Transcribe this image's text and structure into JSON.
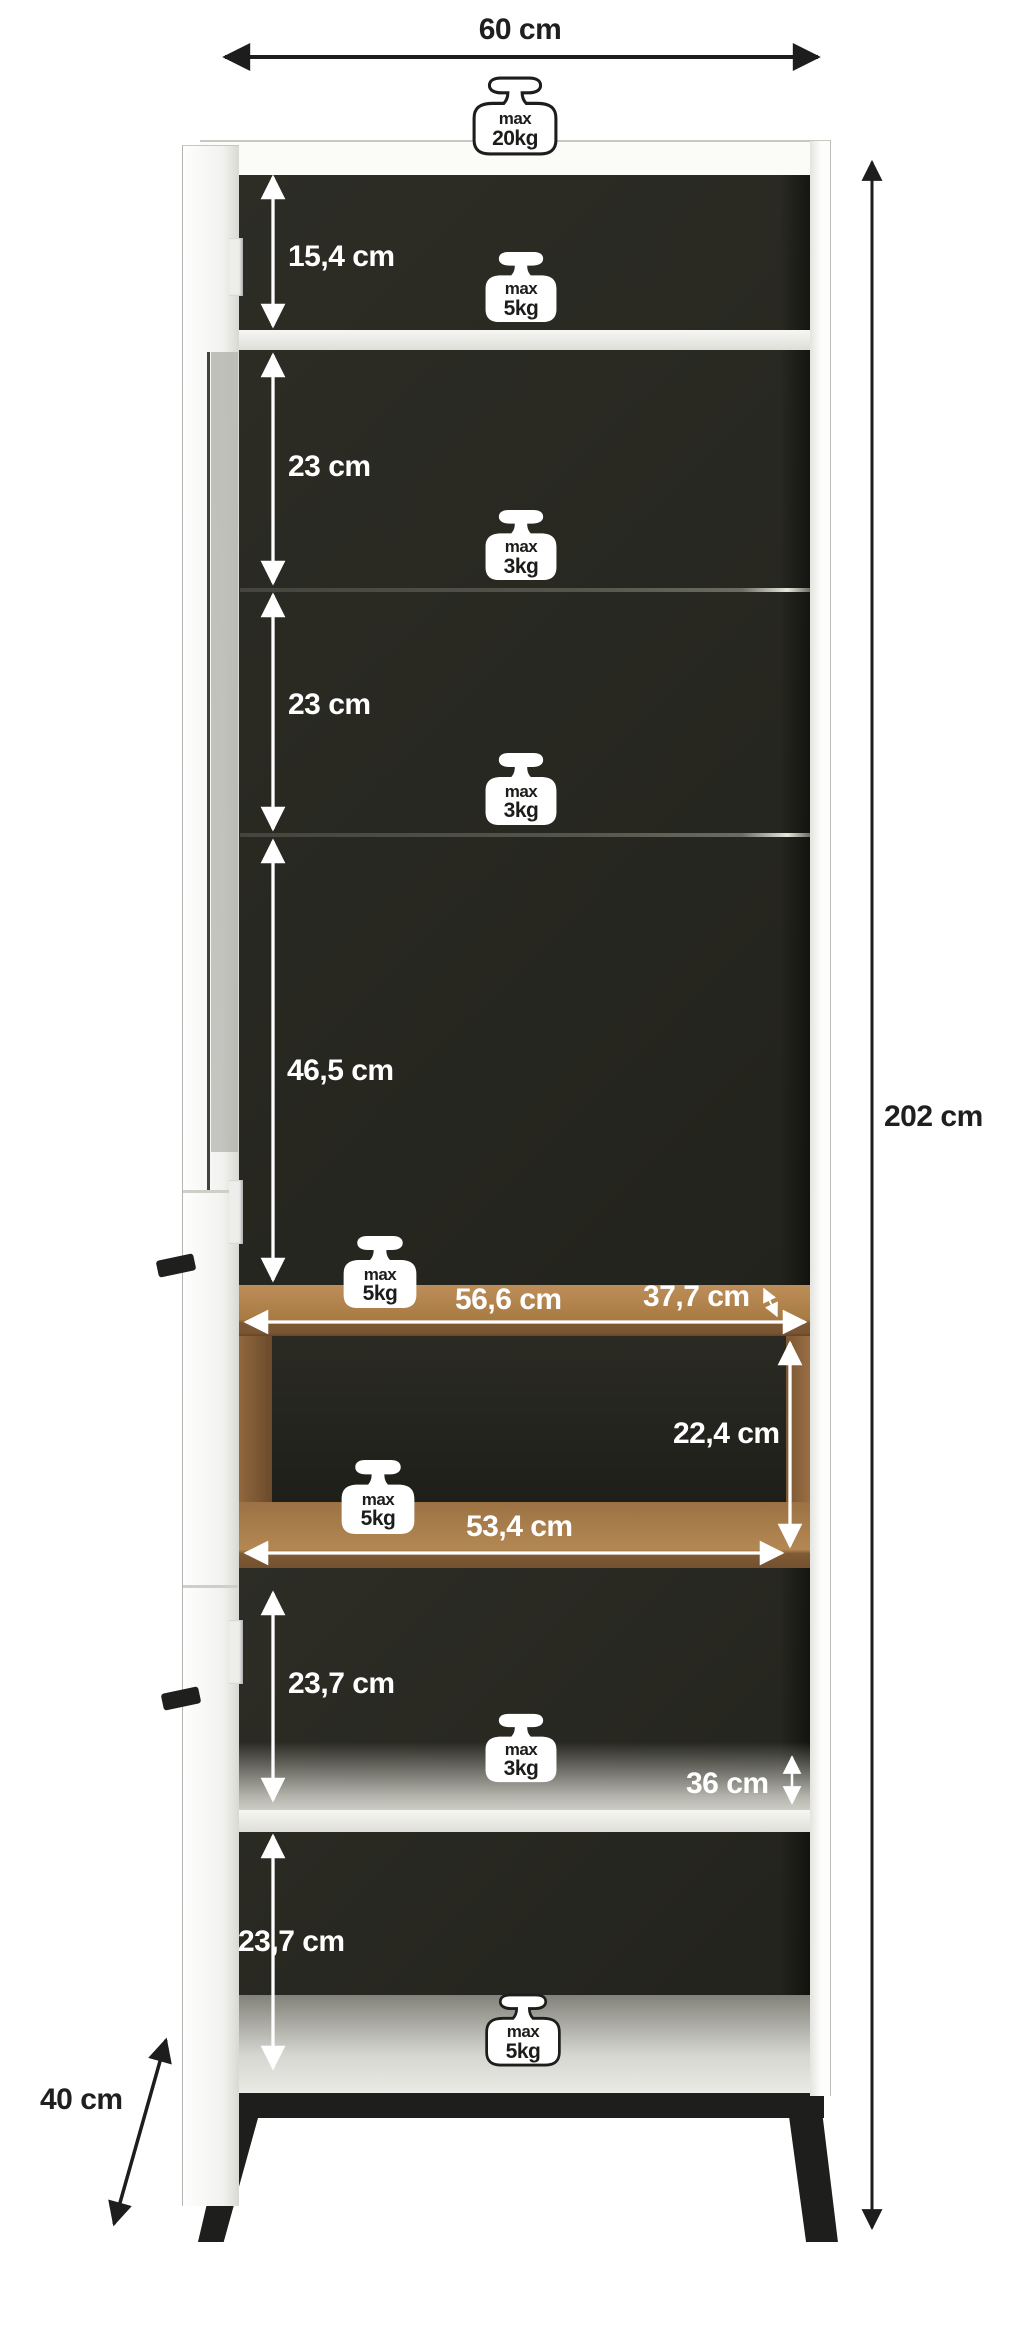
{
  "diagram": {
    "type": "furniture-dimension-diagram",
    "item": "tall display cabinet with glass door, open wooden niche and metal legs"
  },
  "labels": {
    "width": "60 cm",
    "height": "202 cm",
    "depth": "40 cm",
    "sec1": "15,4 cm",
    "sec2": "23 cm",
    "sec3": "23 cm",
    "sec4": "46,5 cm",
    "shelf_width": "56,6 cm",
    "shelf_depth": "37,7 cm",
    "niche_height": "22,4 cm",
    "niche_width": "53,4 cm",
    "sec5": "23,7 cm",
    "lower_shelf_depth": "36 cm",
    "sec6": "23,7 cm"
  },
  "weights": {
    "top": {
      "line1": "max",
      "line2": "20kg"
    },
    "shelf1": {
      "line1": "max",
      "line2": "5kg"
    },
    "shelf2": {
      "line1": "max",
      "line2": "3kg"
    },
    "shelf3": {
      "line1": "max",
      "line2": "3kg"
    },
    "shelf4": {
      "line1": "max",
      "line2": "5kg"
    },
    "niche": {
      "line1": "max",
      "line2": "5kg"
    },
    "shelf5": {
      "line1": "max",
      "line2": "3kg"
    },
    "bottom": {
      "line1": "max",
      "line2": "5kg"
    }
  },
  "colors": {
    "wood": "#a87a43",
    "interior": "#26261f",
    "frame": "#ffffff",
    "base": "#1e1e1c",
    "dimension_text_light": "#ffffff",
    "dimension_text_dark": "#1f1f1f"
  }
}
